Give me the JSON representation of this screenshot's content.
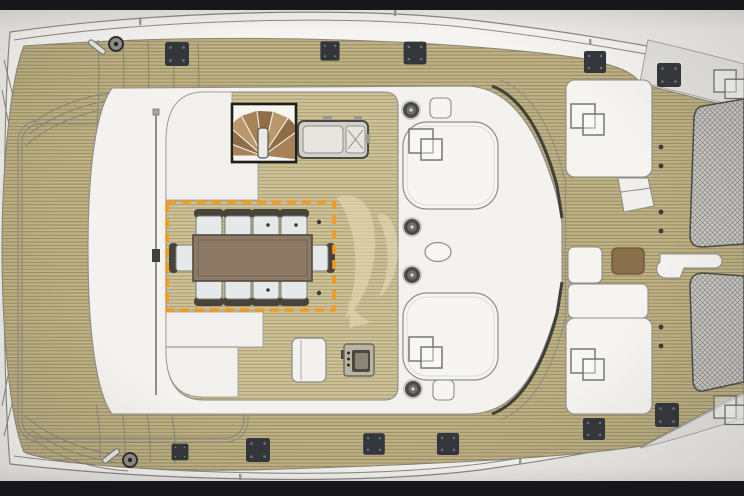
{
  "meta": {
    "title": "Catamaran flybridge deck plan",
    "view": "top-down technical drawing photographed on a screen",
    "visible_text": "none"
  },
  "selection": {
    "target": "dining-area",
    "shape": "dashed-rectangle",
    "color": "#F29A1F",
    "contents": "rectangular dining table with 10 chairs"
  },
  "watermark": {
    "name": "sail-logo-watermark",
    "color": "#E3D9B5"
  },
  "inventory": {
    "dining_tables": 1,
    "dining_chairs": 10,
    "spiral_staircases": 1,
    "wet_bar_modules": 1,
    "grill_consoles": 1,
    "bench_seats": 3,
    "cocktail_tables": 1,
    "winches": 4,
    "deck_cleats": 11,
    "mooring_fittings": 2,
    "hatch_groups": 6,
    "roof_hatches": 2,
    "trampoline_nets": 2,
    "stanchion_dots": 6
  },
  "colors": {
    "page-bg": "#ECEBE7",
    "bezel": "#17171A",
    "hull-white": "#F5F4F0",
    "line": "#8F8D88",
    "line-dark": "#4A4A46",
    "teak-base": "#BFB284",
    "teak-stripe": "#938760",
    "teak-light-base": "#CEC298",
    "teak-light-stripe": "#A3966C",
    "net-bg": "#CBCAC5",
    "net-line": "#8B8A85",
    "selection": "#F29A1F",
    "table-brown": "#8D7A66",
    "chair-seat": "#E5E9E9",
    "chair-back": "#47433A",
    "stair-brown-1": "#A88257",
    "stair-brown-2": "#8F6D49",
    "stair-brown-3": "#BB976C",
    "cocktail-brown": "#8A6F4D",
    "module-gray": "#D2D1CC",
    "cleat": "#33363A",
    "watermark": "#E3D9B5",
    "corner-gray": "#E4E3DE"
  }
}
